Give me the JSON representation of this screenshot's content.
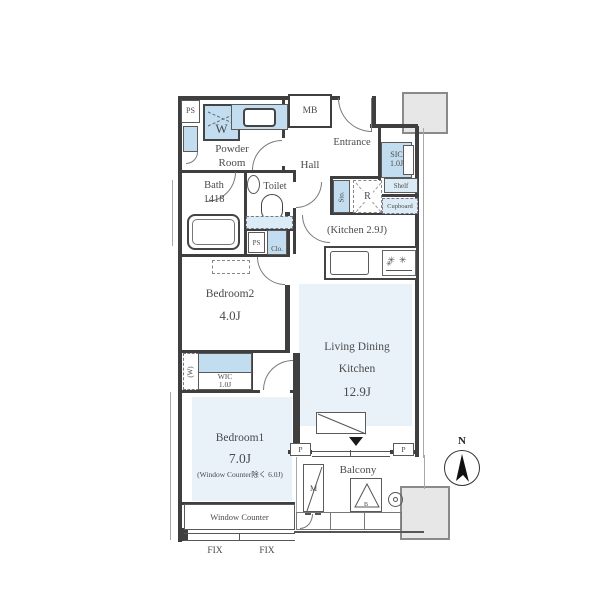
{
  "colors": {
    "wall": "#3f3f3f",
    "room_fill": "#e9f2f9",
    "fixture_fill": "#c2ddef",
    "fixture_fill_light": "#dcecf7",
    "line": "#7a7a7a",
    "text": "#4a4a4a",
    "gray_block": "#e7e7e7"
  },
  "rooms": {
    "powder_room": "Powder\nRoom",
    "bath": "Bath\n1418",
    "toilet": "Toilet",
    "hall": "Hall",
    "entrance": "Entrance",
    "kitchen_note": "(Kitchen 2.9J)",
    "bedroom2_name": "Bedroom2",
    "bedroom2_size": "4.0J",
    "ldk_line1": "Living Dining",
    "ldk_line2": "Kitchen",
    "ldk_size": "12.9J",
    "bedroom1_name": "Bedroom1",
    "bedroom1_size": "7.0J",
    "bedroom1_note": "(Window Counter除く 6.0J)",
    "balcony": "Balcony"
  },
  "storage": {
    "sic": "SIC\n1.0J",
    "sic_shelf": "Shelf",
    "wic": "WIC\n1.0J",
    "wic_side": "(W)",
    "clo": "Clo.",
    "sto": "Sto.",
    "cupboard": "Cupboard"
  },
  "fixtures": {
    "ps_top": "PS",
    "ps_mid": "PS",
    "mb": "MB",
    "washer": "W",
    "refrigerator": "R",
    "window_counter": "Window Counter",
    "fix_left": "FIX",
    "fix_right": "FIX",
    "pipe_left": "P",
    "pipe_right": "P",
    "ac_outdoor": "M",
    "hatch": "B",
    "compass_north": "N"
  }
}
